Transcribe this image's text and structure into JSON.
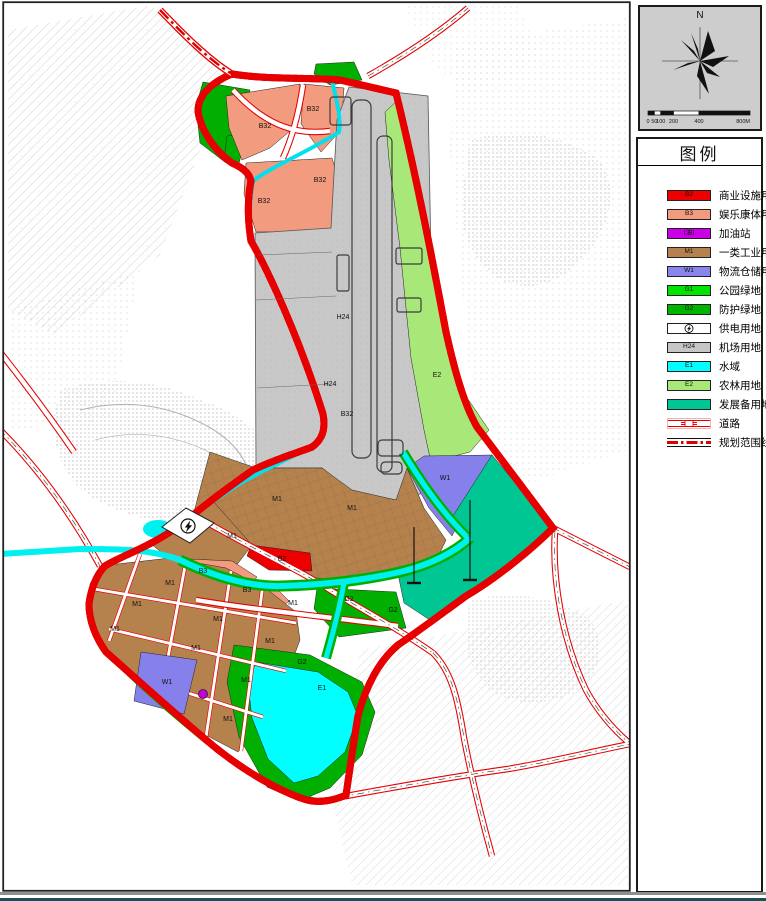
{
  "north_panel": {
    "n": "N",
    "scale": [
      {
        "label": "0",
        "m": 0
      },
      {
        "label": "50",
        "m": 50
      },
      {
        "label": "100",
        "m": 100
      },
      {
        "label": "200",
        "m": 200
      },
      {
        "label": "400",
        "m": 400
      },
      {
        "label": "800M",
        "m": 800
      }
    ]
  },
  "legend": {
    "title": "图例",
    "items": [
      {
        "type": "color",
        "code": "B2",
        "color": "#ee0000",
        "label": "商业设施用地"
      },
      {
        "type": "color",
        "code": "B3",
        "color": "#f29b7e",
        "label": "娱乐康体用地"
      },
      {
        "type": "color",
        "code": "(油)",
        "color": "#cc00e8",
        "label": "加油站"
      },
      {
        "type": "color",
        "code": "M1",
        "color": "#b5824e",
        "label": "一类工业用地"
      },
      {
        "type": "color",
        "code": "W1",
        "color": "#8a85ec",
        "label": "物流仓储用地"
      },
      {
        "type": "color",
        "code": "G1",
        "color": "#00e400",
        "label": "公园绿地"
      },
      {
        "type": "color",
        "code": "G2",
        "color": "#00b400",
        "label": "防护绿地"
      },
      {
        "type": "power",
        "code": "",
        "color": "#ffffff",
        "label": "供电用地"
      },
      {
        "type": "color",
        "code": "H24",
        "color": "#c6c6c6",
        "label": "机场用地"
      },
      {
        "type": "color",
        "code": "E1",
        "color": "#00ffff",
        "label": "水域"
      },
      {
        "type": "color",
        "code": "E2",
        "color": "#a8e878",
        "label": "农林用地"
      },
      {
        "type": "color",
        "code": "",
        "color": "#00c694",
        "label": "发展备用地"
      },
      {
        "type": "road",
        "code": "",
        "label": "道路"
      },
      {
        "type": "boundary",
        "code": "",
        "label": "规划范围线"
      }
    ]
  },
  "map_labels": [
    {
      "t": "B32",
      "x": 265,
      "y": 128
    },
    {
      "t": "B32",
      "x": 313,
      "y": 111
    },
    {
      "t": "B32",
      "x": 320,
      "y": 182
    },
    {
      "t": "B32",
      "x": 264,
      "y": 203
    },
    {
      "t": "B32",
      "x": 347,
      "y": 416
    },
    {
      "t": "H24",
      "x": 343,
      "y": 319
    },
    {
      "t": "H24",
      "x": 330,
      "y": 386
    },
    {
      "t": "E2",
      "x": 437,
      "y": 377
    },
    {
      "t": "W1",
      "x": 445,
      "y": 480
    },
    {
      "t": "W1",
      "x": 167,
      "y": 684
    },
    {
      "t": "M1",
      "x": 277,
      "y": 501
    },
    {
      "t": "M1",
      "x": 352,
      "y": 510
    },
    {
      "t": "M1",
      "x": 232,
      "y": 538
    },
    {
      "t": "M1",
      "x": 293,
      "y": 605
    },
    {
      "t": "M1",
      "x": 170,
      "y": 585
    },
    {
      "t": "M1",
      "x": 137,
      "y": 606
    },
    {
      "t": "M1",
      "x": 115,
      "y": 631
    },
    {
      "t": "M1",
      "x": 196,
      "y": 650
    },
    {
      "t": "M1",
      "x": 218,
      "y": 621
    },
    {
      "t": "M1",
      "x": 246,
      "y": 682
    },
    {
      "t": "M1",
      "x": 228,
      "y": 721
    },
    {
      "t": "M1",
      "x": 270,
      "y": 643
    },
    {
      "t": "B2",
      "x": 282,
      "y": 561
    },
    {
      "t": "B3",
      "x": 203,
      "y": 573
    },
    {
      "t": "B3",
      "x": 247,
      "y": 592
    },
    {
      "t": "G2",
      "x": 349,
      "y": 601
    },
    {
      "t": "G2",
      "x": 393,
      "y": 612
    },
    {
      "t": "G2",
      "x": 302,
      "y": 664
    },
    {
      "t": "E1",
      "x": 322,
      "y": 690
    }
  ]
}
